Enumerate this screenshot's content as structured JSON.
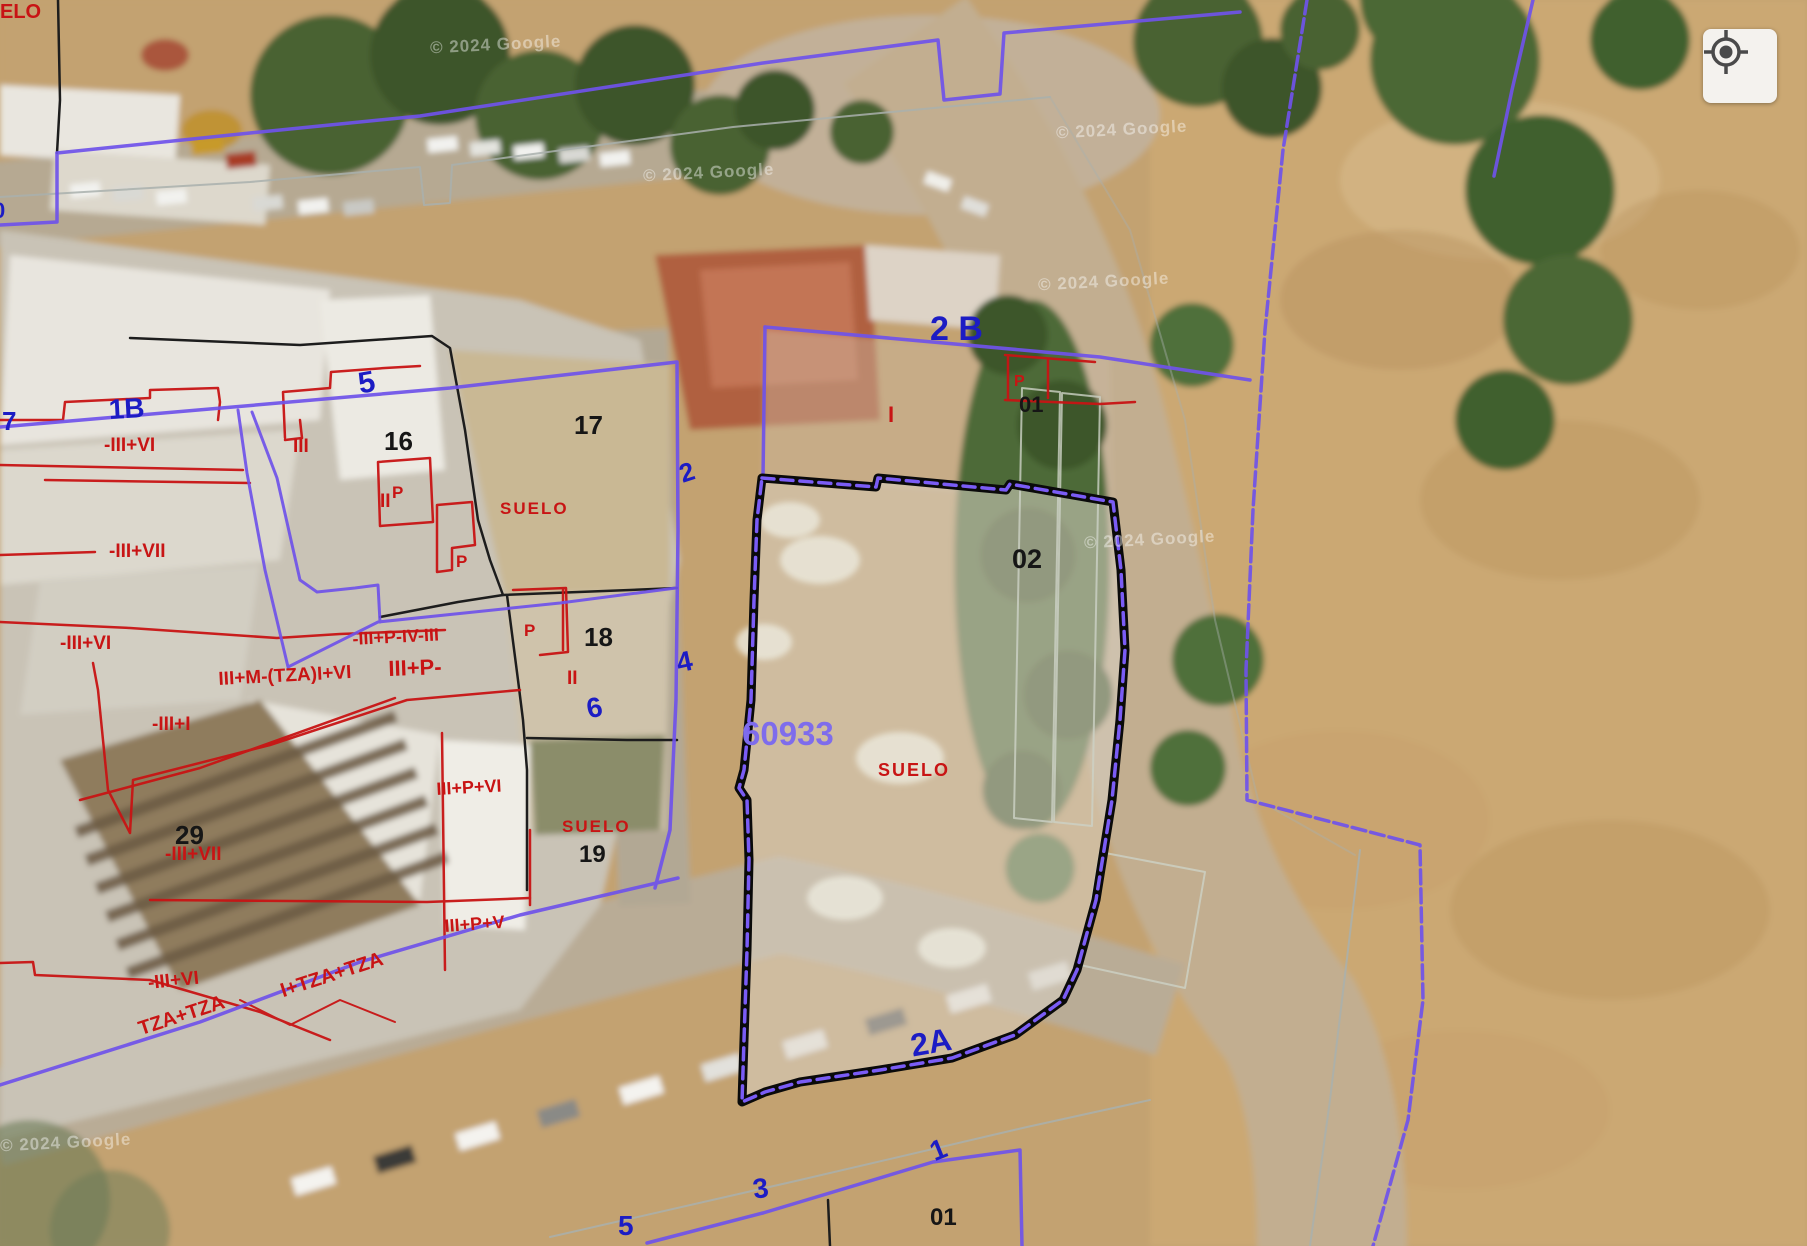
{
  "map": {
    "attribution": "© 2024 Google",
    "watermark_positions": [
      {
        "x": 430,
        "y": 35
      },
      {
        "x": 643,
        "y": 163
      },
      {
        "x": 1056,
        "y": 120
      },
      {
        "x": 1038,
        "y": 272
      },
      {
        "x": 1084,
        "y": 530
      },
      {
        "x": 0,
        "y": 1133
      }
    ],
    "colors": {
      "blue": "#1c1cc4",
      "black": "#161616",
      "red": "#c81414",
      "purple": "#7e6cec"
    },
    "selected_parcel": {
      "block_code": "60933",
      "parcel_number": "02",
      "land_use": "SUELO",
      "street_label": "2A"
    },
    "labels": [
      {
        "t": "ELO",
        "x": 0,
        "y": 2,
        "s": 20,
        "c": "red",
        "r": 0,
        "n": "label-suelo-clipped"
      },
      {
        "t": "0",
        "x": -7,
        "y": 200,
        "s": 22,
        "c": "blue",
        "r": 0,
        "n": "street-number-0"
      },
      {
        "t": "7",
        "x": 2,
        "y": 408,
        "s": 26,
        "c": "blue",
        "r": 0,
        "n": "street-number-7"
      },
      {
        "t": "1B",
        "x": 108,
        "y": 396,
        "s": 28,
        "c": "blue",
        "r": -3,
        "n": "street-number-1b"
      },
      {
        "t": "5",
        "x": 356,
        "y": 370,
        "s": 30,
        "c": "blue",
        "r": -10,
        "n": "street-number-5"
      },
      {
        "t": "2 B",
        "x": 930,
        "y": 312,
        "s": 34,
        "c": "blue",
        "r": 0,
        "n": "street-number-2b"
      },
      {
        "t": "2",
        "x": 676,
        "y": 462,
        "s": 26,
        "c": "blue",
        "r": -18,
        "n": "street-number-2"
      },
      {
        "t": "4",
        "x": 674,
        "y": 650,
        "s": 28,
        "c": "blue",
        "r": -12,
        "n": "street-number-4"
      },
      {
        "t": "6",
        "x": 584,
        "y": 696,
        "s": 28,
        "c": "blue",
        "r": -12,
        "n": "street-number-6"
      },
      {
        "t": "2A",
        "x": 908,
        "y": 1030,
        "s": 32,
        "c": "blue",
        "r": -10,
        "n": "street-number-2a"
      },
      {
        "t": "1",
        "x": 926,
        "y": 1140,
        "s": 28,
        "c": "blue",
        "r": -22,
        "n": "street-number-1"
      },
      {
        "t": "3",
        "x": 751,
        "y": 1176,
        "s": 28,
        "c": "blue",
        "r": -8,
        "n": "street-number-3"
      },
      {
        "t": "5",
        "x": 618,
        "y": 1212,
        "s": 28,
        "c": "blue",
        "r": 0,
        "n": "street-number-5b"
      },
      {
        "t": "60933",
        "x": 742,
        "y": 717,
        "s": 33,
        "c": "purple",
        "r": 0,
        "n": "block-code"
      },
      {
        "t": "16",
        "x": 384,
        "y": 428,
        "s": 26,
        "c": "black",
        "r": 0,
        "n": "parcel-16"
      },
      {
        "t": "17",
        "x": 574,
        "y": 412,
        "s": 26,
        "c": "black",
        "r": 0,
        "n": "parcel-17"
      },
      {
        "t": "18",
        "x": 584,
        "y": 624,
        "s": 26,
        "c": "black",
        "r": 0,
        "n": "parcel-18"
      },
      {
        "t": "19",
        "x": 579,
        "y": 843,
        "s": 24,
        "c": "black",
        "r": 0,
        "n": "parcel-19"
      },
      {
        "t": "29",
        "x": 175,
        "y": 822,
        "s": 26,
        "c": "black",
        "r": 0,
        "n": "parcel-29"
      },
      {
        "t": "01",
        "x": 1019,
        "y": 394,
        "s": 22,
        "c": "black",
        "r": 0,
        "n": "parcel-01"
      },
      {
        "t": "02",
        "x": 1012,
        "y": 546,
        "s": 27,
        "c": "black",
        "r": 0,
        "n": "parcel-02"
      },
      {
        "t": "01",
        "x": 930,
        "y": 1206,
        "s": 24,
        "c": "black",
        "r": 0,
        "n": "parcel-01b"
      },
      {
        "t": "-III+VI",
        "x": 104,
        "y": 436,
        "s": 19,
        "c": "red",
        "r": 0,
        "n": "storeys"
      },
      {
        "t": "III",
        "x": 293,
        "y": 437,
        "s": 19,
        "c": "red",
        "r": 0,
        "n": "storeys"
      },
      {
        "t": "II",
        "x": 380,
        "y": 492,
        "s": 19,
        "c": "red",
        "r": 0,
        "n": "storeys"
      },
      {
        "t": "-III+VII",
        "x": 109,
        "y": 542,
        "s": 19,
        "c": "red",
        "r": 0,
        "n": "storeys"
      },
      {
        "t": "SUELO",
        "x": 500,
        "y": 500,
        "s": 17,
        "c": "red",
        "r": 0,
        "ls": 2,
        "n": "land-use-17"
      },
      {
        "t": "P",
        "x": 392,
        "y": 484,
        "s": 17,
        "c": "red",
        "r": 0,
        "n": "storeys"
      },
      {
        "t": "P",
        "x": 456,
        "y": 553,
        "s": 17,
        "c": "red",
        "r": 0,
        "n": "storeys"
      },
      {
        "t": "P",
        "x": 524,
        "y": 622,
        "s": 17,
        "c": "red",
        "r": 0,
        "n": "storeys"
      },
      {
        "t": "P",
        "x": 1014,
        "y": 374,
        "s": 16,
        "c": "red",
        "r": 0,
        "n": "storeys"
      },
      {
        "t": "I",
        "x": 888,
        "y": 404,
        "s": 22,
        "c": "red",
        "r": 0,
        "n": "storeys"
      },
      {
        "t": "-III+P-IV-III",
        "x": 352,
        "y": 630,
        "s": 18,
        "c": "red",
        "r": -3,
        "n": "storeys"
      },
      {
        "t": "III+P-",
        "x": 388,
        "y": 658,
        "s": 22,
        "c": "red",
        "r": -2,
        "n": "storeys"
      },
      {
        "t": "III+M-(TZA)I+VI",
        "x": 218,
        "y": 670,
        "s": 19,
        "c": "red",
        "r": -3,
        "n": "storeys"
      },
      {
        "t": "-III+VI",
        "x": 60,
        "y": 634,
        "s": 19,
        "c": "red",
        "r": 0,
        "n": "storeys"
      },
      {
        "t": "-III+I",
        "x": 152,
        "y": 715,
        "s": 19,
        "c": "red",
        "r": 0,
        "n": "storeys"
      },
      {
        "t": "II",
        "x": 567,
        "y": 669,
        "s": 19,
        "c": "red",
        "r": 0,
        "n": "storeys"
      },
      {
        "t": "-III+VII",
        "x": 165,
        "y": 845,
        "s": 19,
        "c": "red",
        "r": 0,
        "n": "storeys"
      },
      {
        "t": "III+P+VI",
        "x": 436,
        "y": 780,
        "s": 18,
        "c": "red",
        "r": -3,
        "n": "storeys"
      },
      {
        "t": "SUELO",
        "x": 562,
        "y": 818,
        "s": 17,
        "c": "red",
        "r": 0,
        "ls": 2,
        "n": "land-use-19"
      },
      {
        "t": "III+P+V",
        "x": 444,
        "y": 917,
        "s": 18,
        "c": "red",
        "r": -4,
        "n": "storeys"
      },
      {
        "t": "-III+VI",
        "x": 147,
        "y": 974,
        "s": 19,
        "c": "red",
        "r": -6,
        "n": "storeys"
      },
      {
        "t": "I+TZA+TZA",
        "x": 278,
        "y": 982,
        "s": 20,
        "c": "red",
        "r": -18,
        "n": "storeys"
      },
      {
        "t": "TZA+TZA",
        "x": 136,
        "y": 1020,
        "s": 20,
        "c": "red",
        "r": -18,
        "n": "storeys"
      },
      {
        "t": "SUELO",
        "x": 878,
        "y": 761,
        "s": 18,
        "c": "red",
        "r": 0,
        "ls": 2,
        "n": "land-use-selected"
      }
    ]
  },
  "controls": {
    "geolocate_icon": "crosshair-icon"
  }
}
